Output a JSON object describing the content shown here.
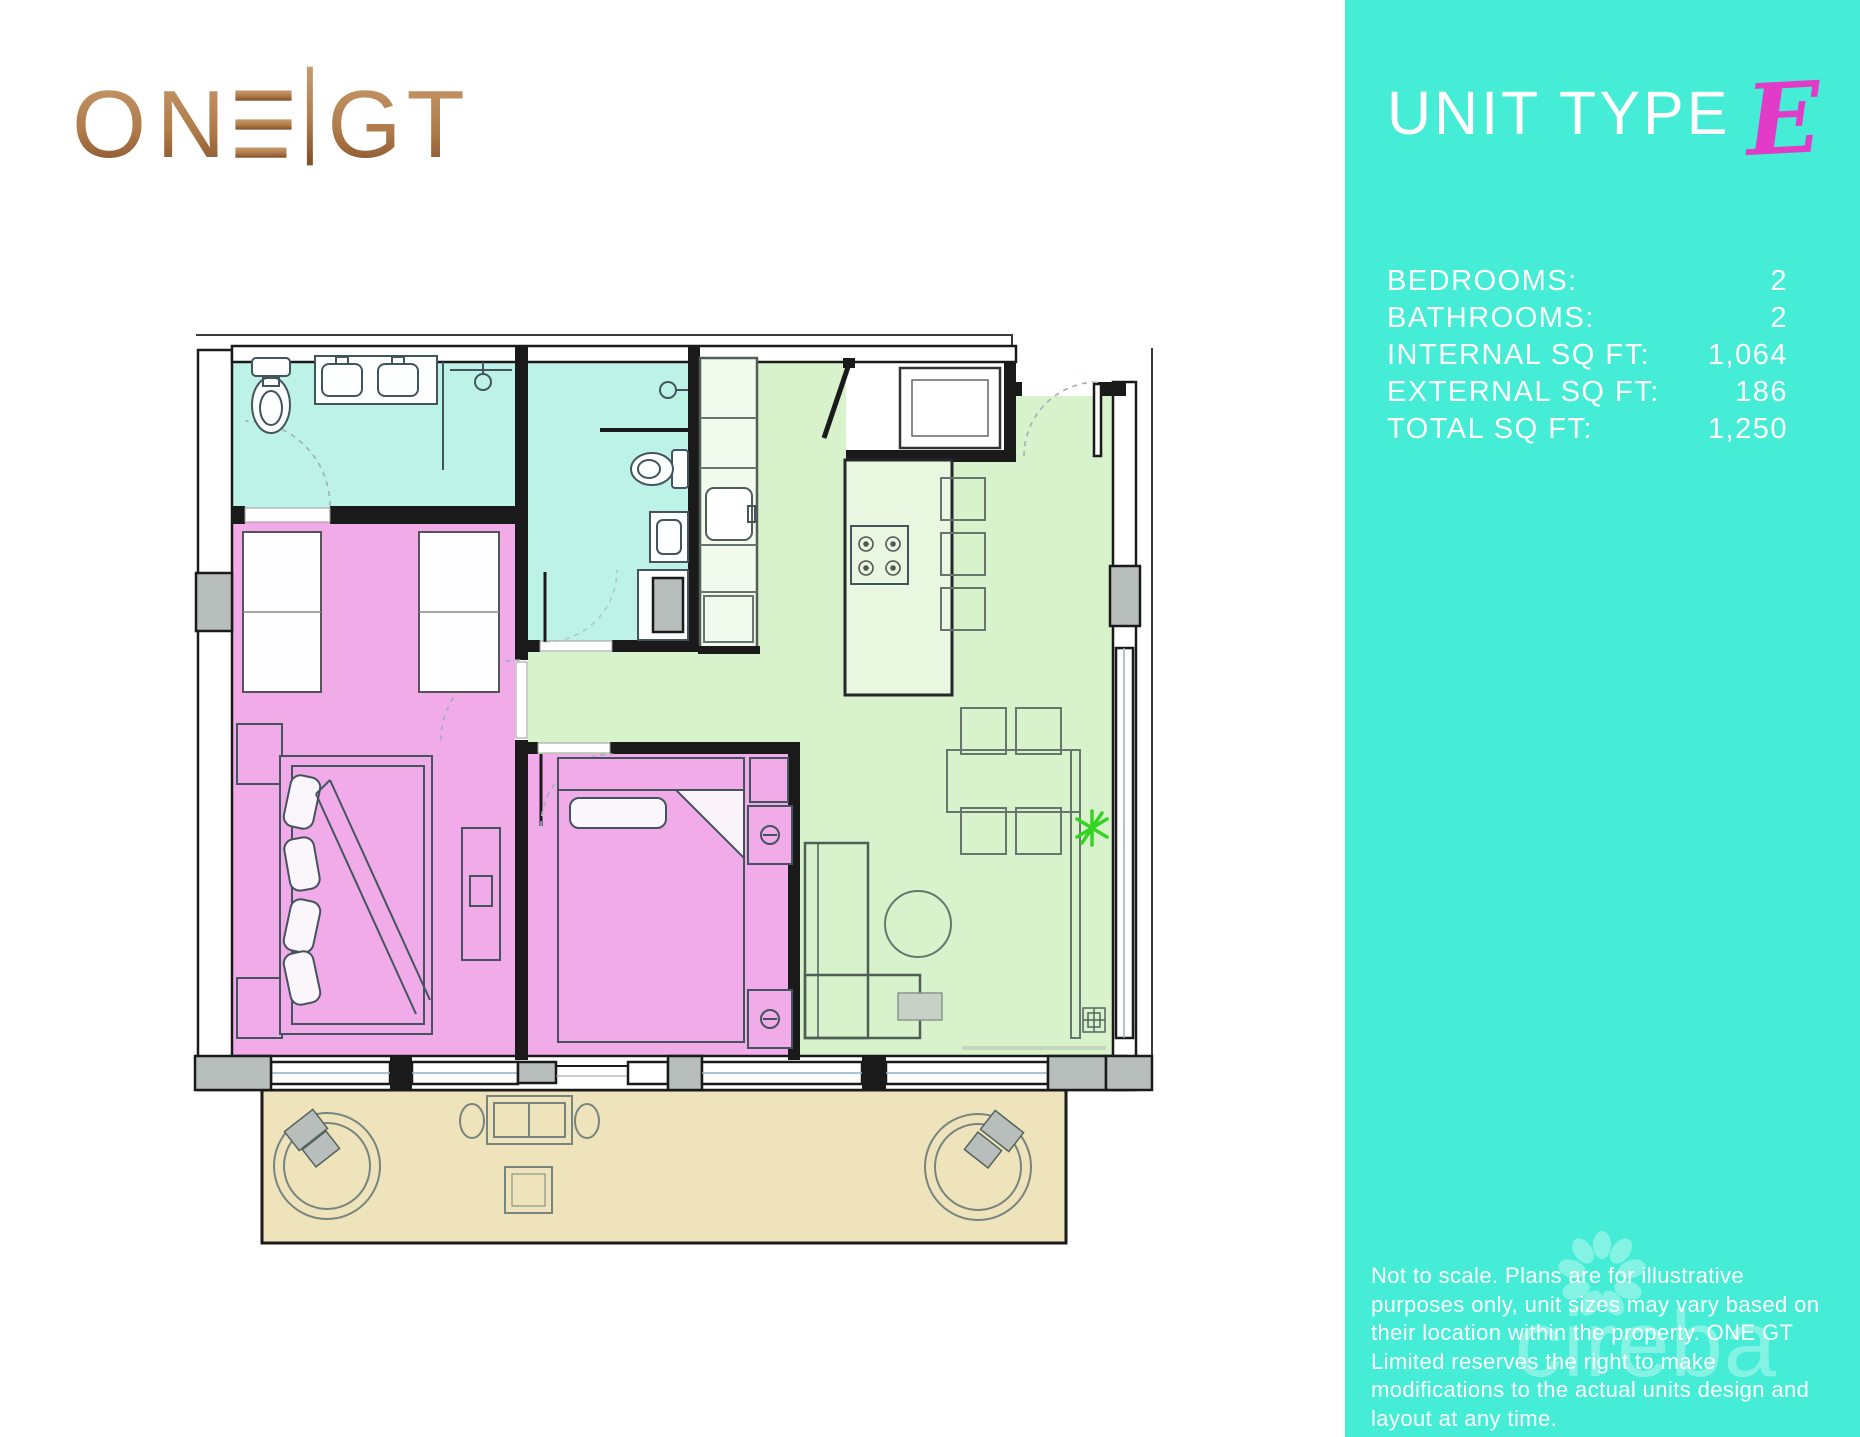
{
  "brand": {
    "name": "ONE GT",
    "logo_left": "ON",
    "logo_right": "GT"
  },
  "panel": {
    "title": "UNIT TYPE",
    "unit_letter": "E",
    "specs": [
      {
        "label": "BEDROOMS:",
        "value": "2"
      },
      {
        "label": "BATHROOMS:",
        "value": "2"
      },
      {
        "label": "INTERNAL SQ FT:",
        "value": "1,064"
      },
      {
        "label": "EXTERNAL SQ FT:",
        "value": "186"
      },
      {
        "label": "TOTAL SQ FT:",
        "value": "1,250"
      }
    ],
    "disclaimer": "Not to scale. Plans are for illustrative purposes only, unit sizes may vary based on their location within the property. ONE GT Limited reserves the right to make modifications to the actual units design and layout at any time.",
    "watermark": "cireba"
  },
  "colors": {
    "panel_teal": "#45EDD6",
    "accent_magenta": "#E23BC8",
    "logo_gold_light": "#C79B6E",
    "logo_gold_dark": "#8A5A33",
    "room_bathroom": "#BDF2E7",
    "room_bedroom": "#F2ABE9",
    "room_living": "#D8F2CB",
    "room_balcony": "#EFE3BC",
    "column_gray": "#B7BEBB",
    "plant_green": "#35D424"
  },
  "floorplan": {
    "rooms": [
      "master-bathroom",
      "bathroom-2",
      "bedroom-1",
      "bedroom-2",
      "kitchen-living-dining",
      "entry-vestibule",
      "balcony"
    ]
  }
}
